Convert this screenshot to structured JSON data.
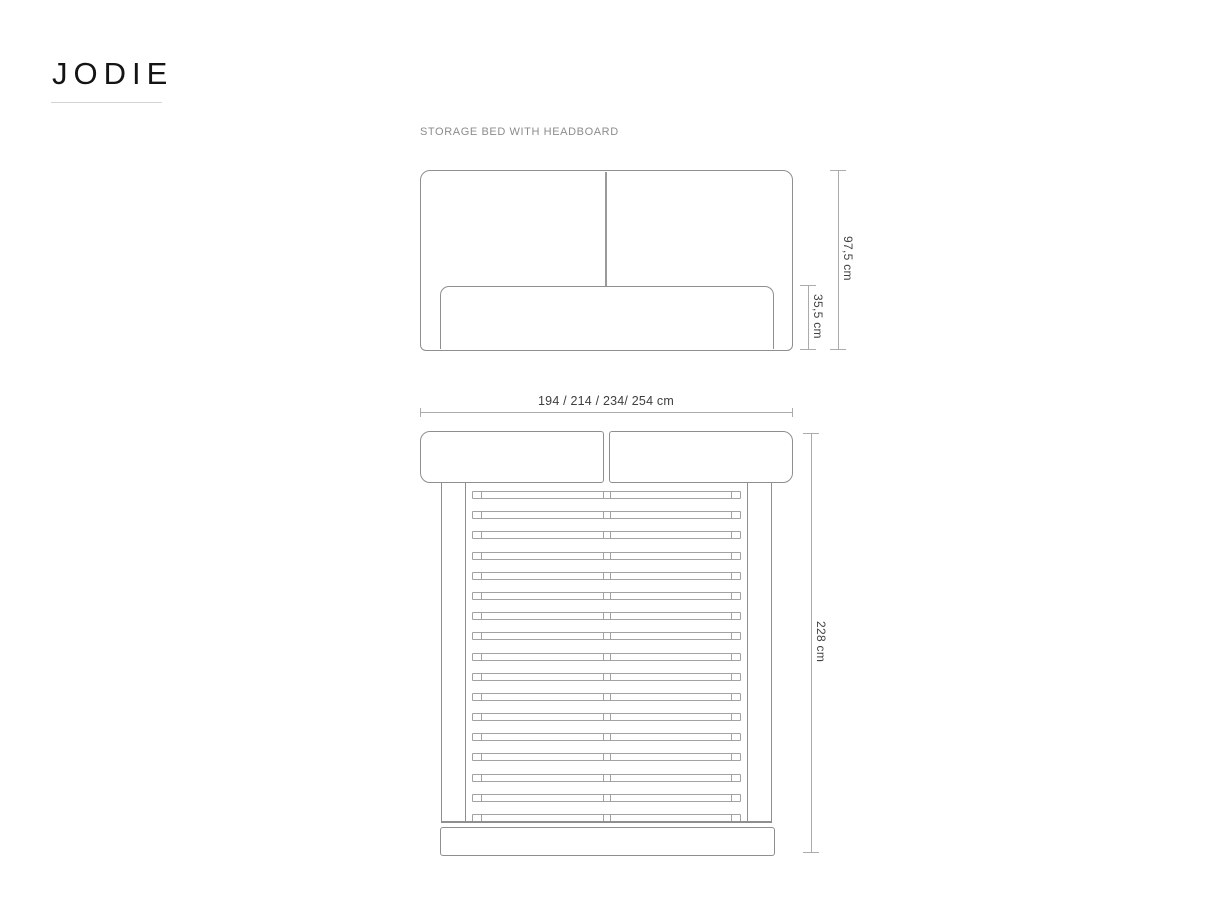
{
  "logo": {
    "text": "JODIE"
  },
  "header": {
    "subtitle": "STORAGE BED WITH HEADBOARD"
  },
  "dimensions": {
    "total_height": "97,5 cm",
    "frame_height": "35,5 cm",
    "width_options": "194 / 214 / 234/ 254 cm",
    "total_length": "228 cm"
  },
  "drawing": {
    "views": [
      "front-elevation",
      "top-plan"
    ],
    "slat_count": 17,
    "colors": {
      "outline": "#8f8f8f",
      "slat": "#a2a2a2",
      "dimension_line": "#ababab",
      "dimension_text": "#424242",
      "logo_text": "#141414",
      "subtitle_text": "#8c8c8c",
      "logo_underline": "#d4d4d4",
      "background": "#ffffff"
    }
  }
}
